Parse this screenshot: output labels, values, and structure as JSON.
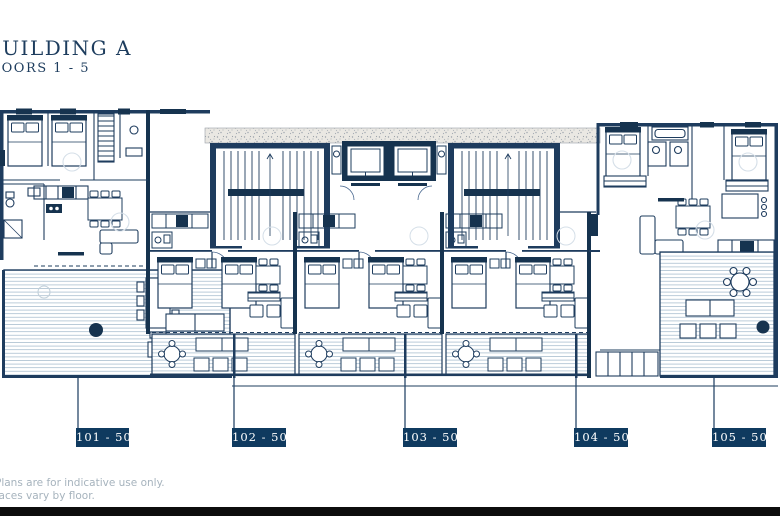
{
  "header": {
    "title": "BUILDING A",
    "subtitle": "FLOORS 1 - 5"
  },
  "units": [
    {
      "label": "101 - 501"
    },
    {
      "label": "102 - 502"
    },
    {
      "label": "103 - 503"
    },
    {
      "label": "104 - 504"
    },
    {
      "label": "105 - 505"
    }
  ],
  "footer": {
    "line1": "Plans are for indicative use only.",
    "line2": "Terraces vary by floor."
  },
  "plan": {
    "type": "architectural-floor-plan",
    "features": [
      "five-apartment-units",
      "stair-core-left",
      "elevator-bank",
      "stair-core-right",
      "corridor-band",
      "terraces-with-decking",
      "beds",
      "dining-tables",
      "sofas",
      "kitchens",
      "bathrooms"
    ]
  },
  "colors": {
    "line_navy": "#1e3c5e",
    "wall_dark": "#16334f",
    "label_bg": "#0f3a5f",
    "label_text": "#ffffff",
    "deck_line": "#aabfd0",
    "stipple_bg": "#eae8e3",
    "disclaimer_text": "#a6b3bd",
    "footer_bar": "#0d0d0d"
  }
}
